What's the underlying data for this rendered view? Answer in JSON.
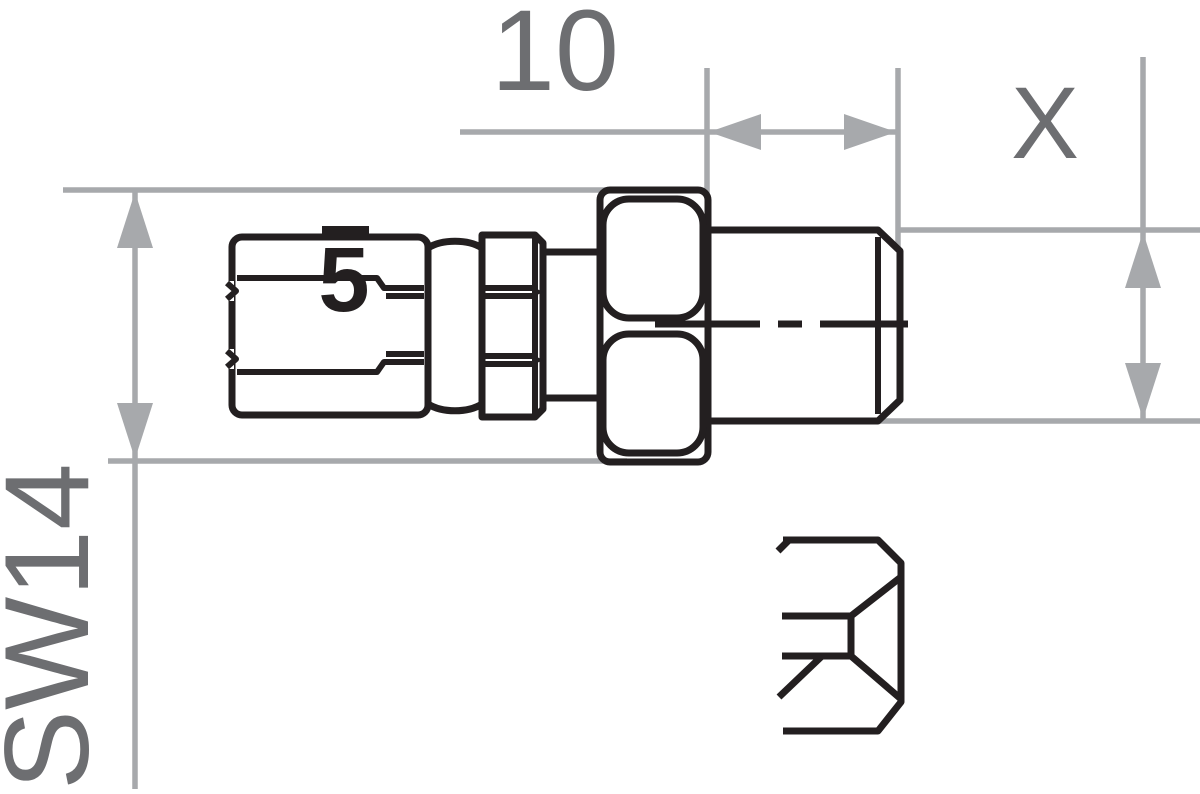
{
  "drawing": {
    "type": "technical-dimension-drawing",
    "labels": {
      "thread_length_dim": "10",
      "thread_diameter_dim": "X",
      "wrench_size_dim": "SW14",
      "part_marking": "5"
    },
    "colors": {
      "outline": "#231f20",
      "dimension_line": "#a7a9ac",
      "dimension_text": "#6d6e71",
      "background": "#ffffff"
    }
  }
}
